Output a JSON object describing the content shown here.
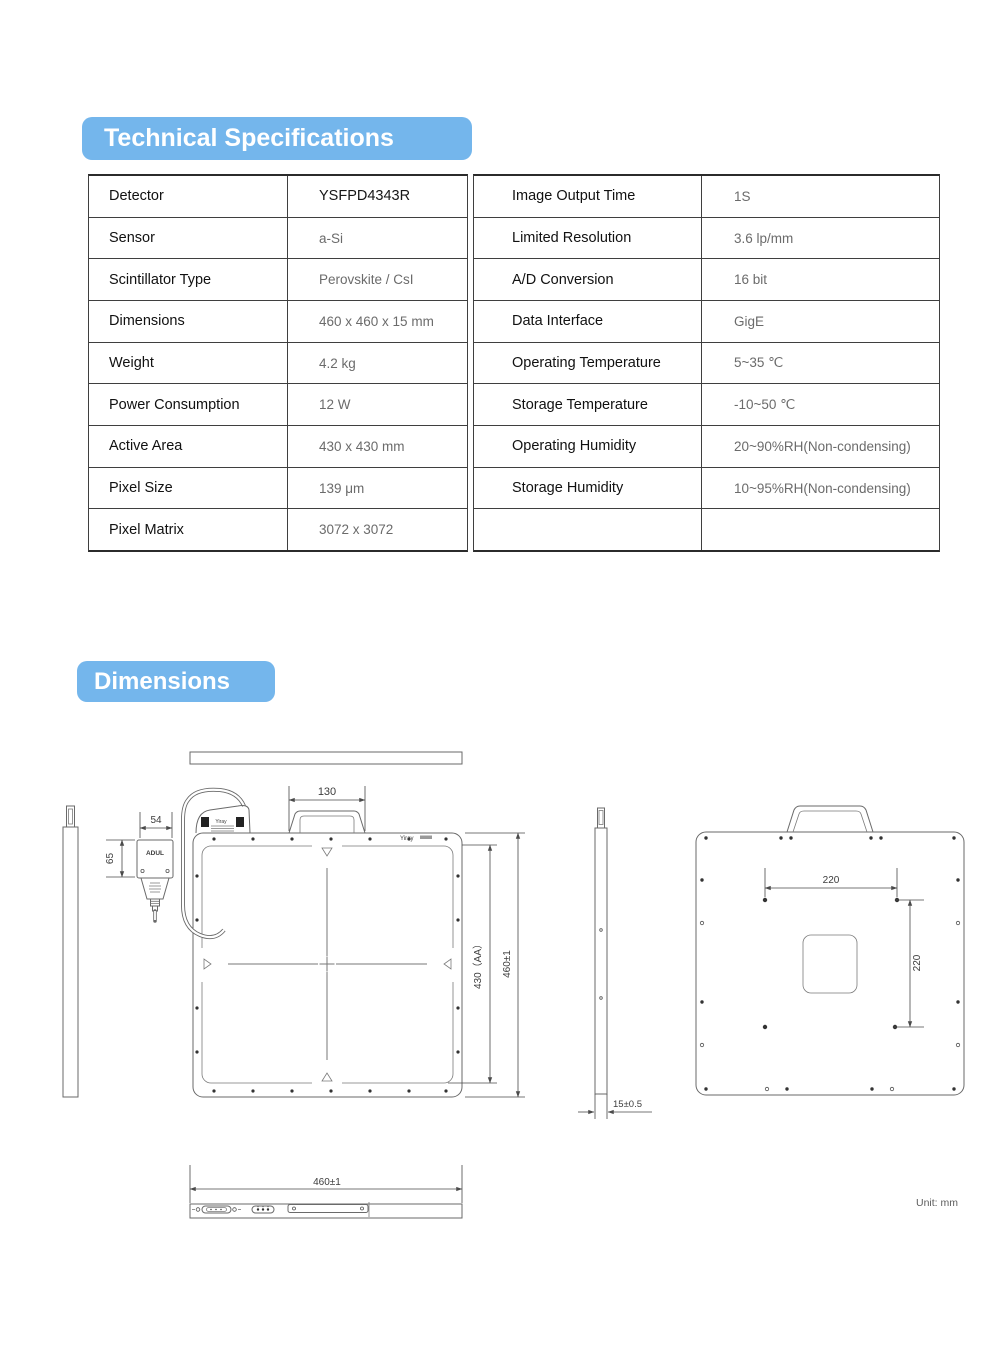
{
  "headings": {
    "technical_specifications": "Technical Specifications",
    "dimensions": "Dimensions"
  },
  "spec_left": {
    "rows": [
      {
        "label": "Detector",
        "value": "YSFPD4343R"
      },
      {
        "label": "Sensor",
        "value": "a-Si"
      },
      {
        "label": "Scintillator Type",
        "value": "Perovskite / CsI"
      },
      {
        "label": "Dimensions",
        "value": "460 x 460 x 15 mm"
      },
      {
        "label": "Weight",
        "value": "4.2 kg"
      },
      {
        "label": "Power Consumption",
        "value": "12 W"
      },
      {
        "label": "Active Area",
        "value": "430 x 430 mm"
      },
      {
        "label": "Pixel Size",
        "value": "139 μm"
      },
      {
        "label": "Pixel Matrix",
        "value": "3072 x 3072"
      }
    ]
  },
  "spec_right": {
    "rows": [
      {
        "label": "Image Output Time",
        "value": "1S"
      },
      {
        "label": "Limited Resolution",
        "value": "3.6 lp/mm"
      },
      {
        "label": "A/D Conversion",
        "value": "16 bit"
      },
      {
        "label": "Data Interface",
        "value": "GigE"
      },
      {
        "label": "Operating Temperature",
        "value": "5~35 ℃"
      },
      {
        "label": "Storage Temperature",
        "value": "-10~50 ℃"
      },
      {
        "label": "Operating Humidity",
        "value": "20~90%RH(Non-condensing)"
      },
      {
        "label": "Storage Humidity",
        "value": "10~95%RH(Non-condensing)"
      },
      {
        "label": "",
        "value": ""
      }
    ]
  },
  "drawing": {
    "handle_width": "130",
    "connector_width": "54",
    "connector_height": "65",
    "active_area_height": "430（AA）",
    "panel_height": "460±1",
    "panel_width": "460±1",
    "mount_width": "220",
    "mount_height": "220",
    "thickness": "15±0.5",
    "brand": "Yiray",
    "connector_brand": "ADUL",
    "unit_note": "Unit: mm"
  },
  "colors": {
    "accent_blue": "#74b6ec",
    "label_text": "#111111",
    "value_text": "#6b6b6b",
    "line": "#6a6a6a"
  }
}
